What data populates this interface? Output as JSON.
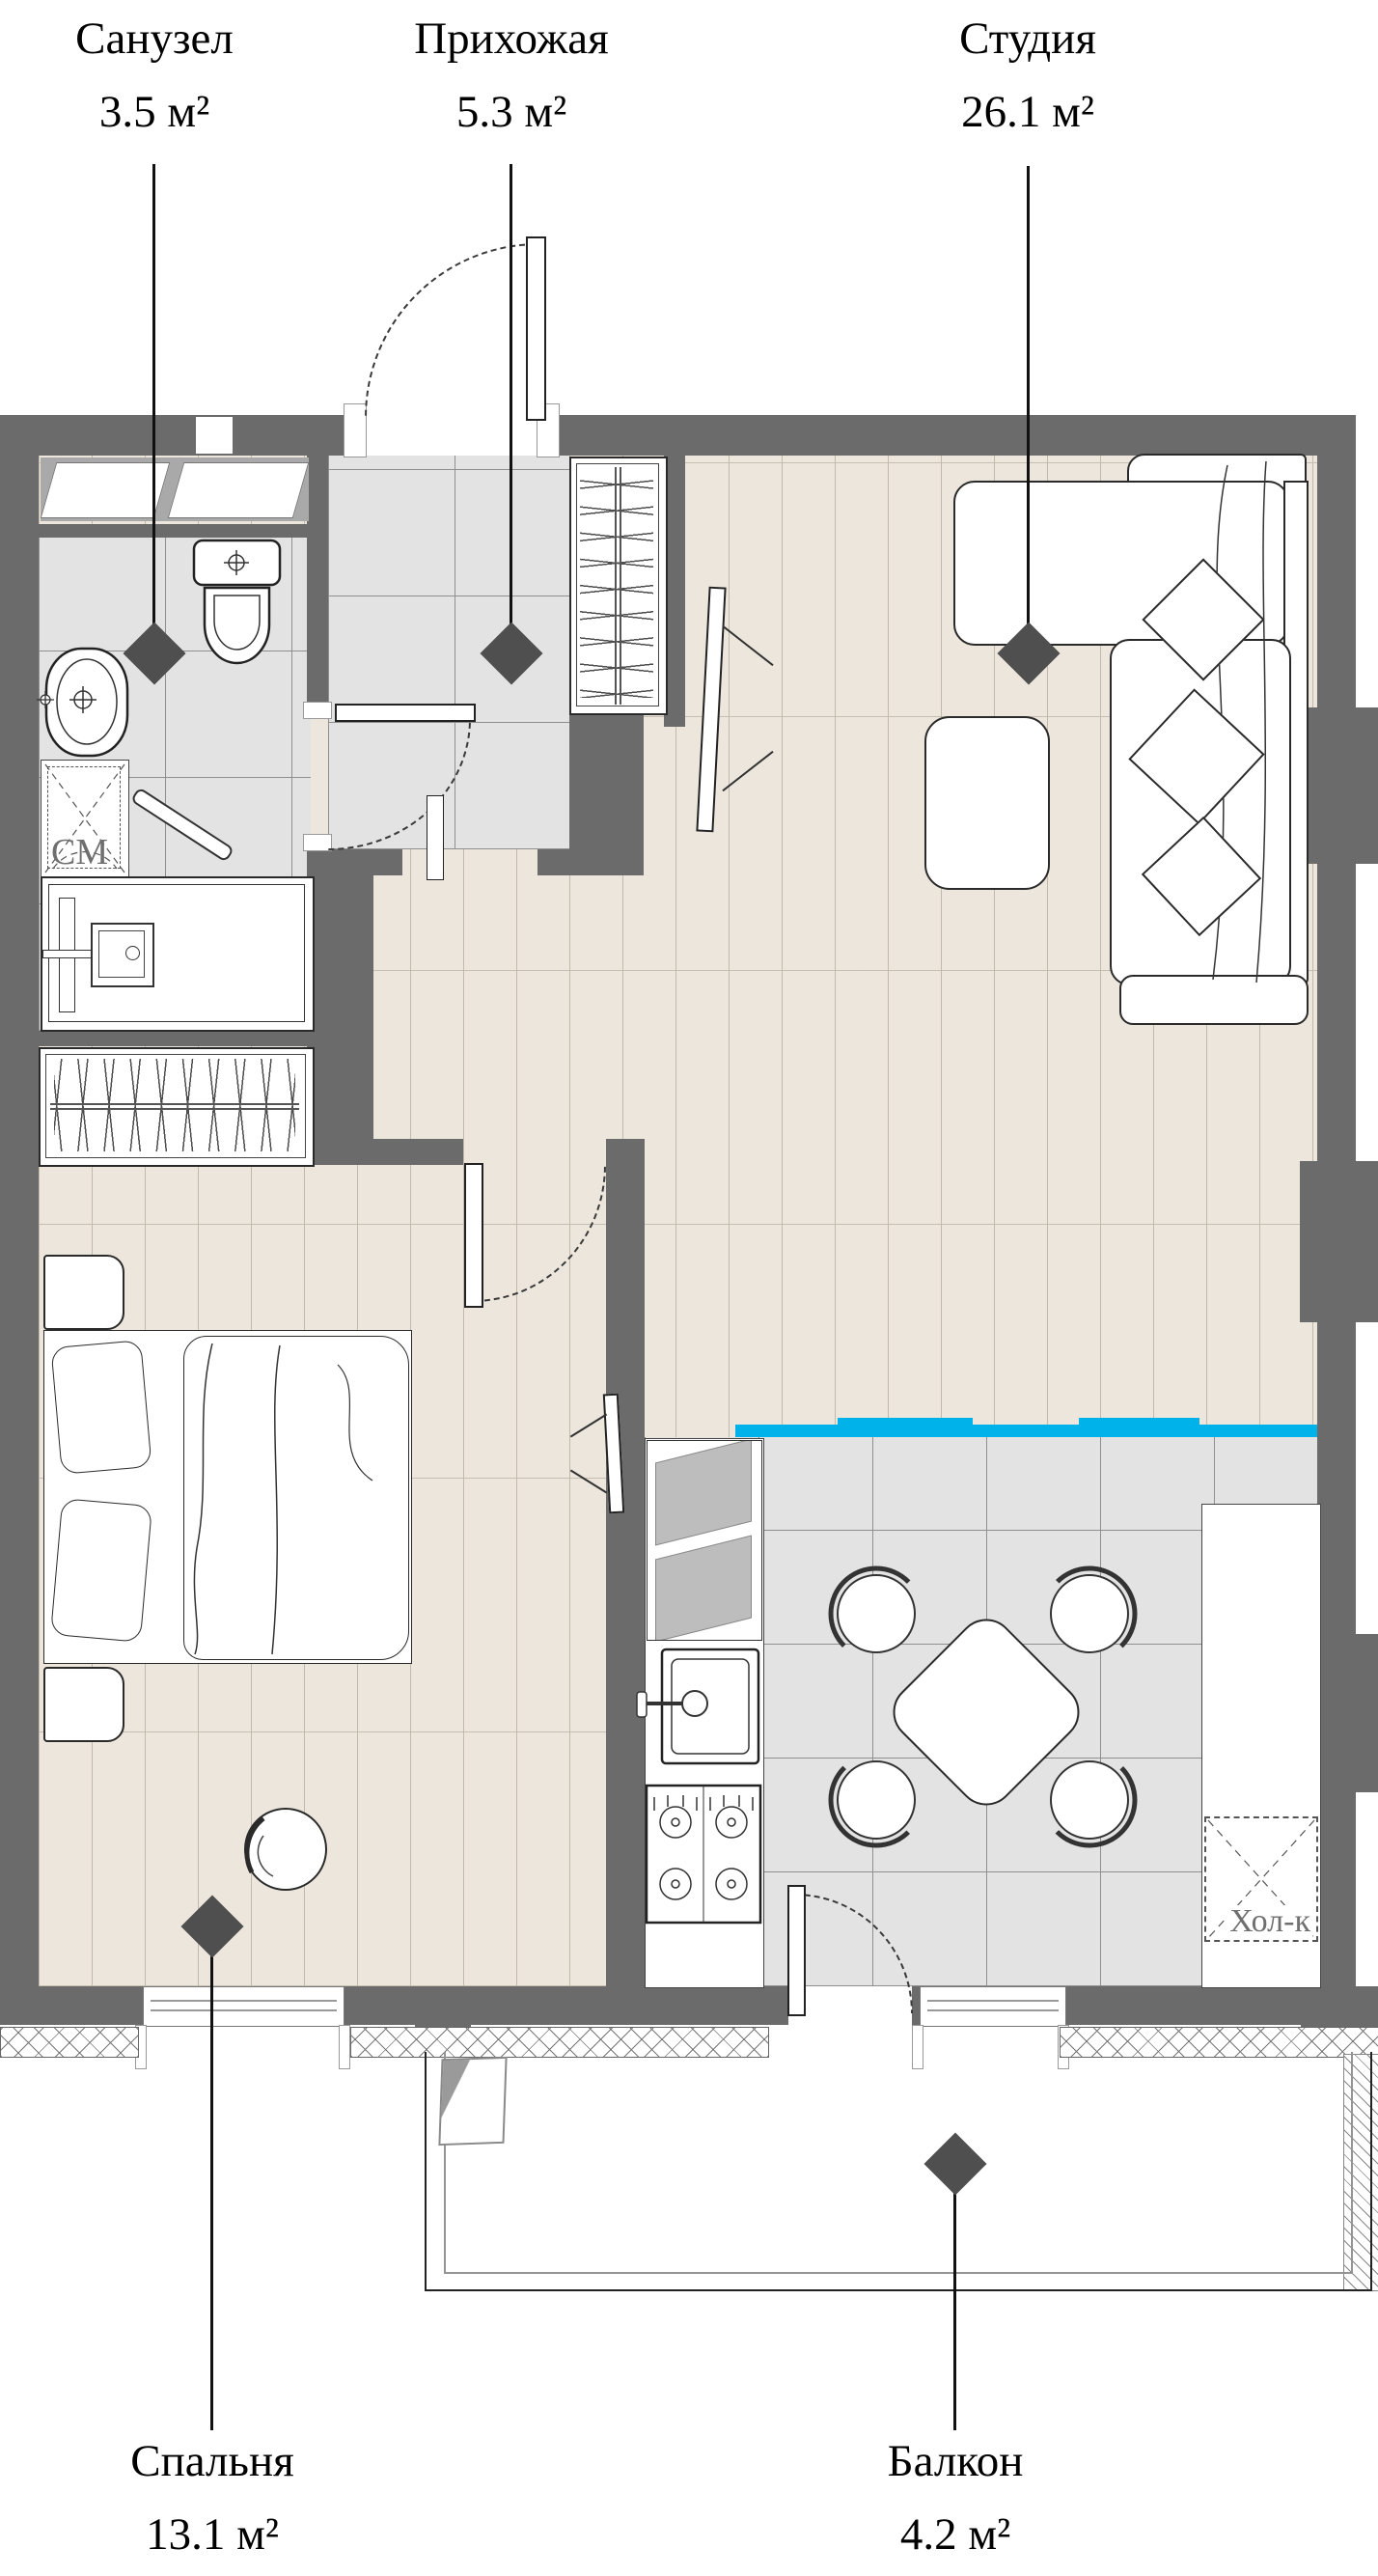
{
  "rooms": [
    {
      "id": "bathroom",
      "name": "Санузел",
      "area": "3.5 м²"
    },
    {
      "id": "hallway",
      "name": "Прихожая",
      "area": "5.3 м²"
    },
    {
      "id": "studio",
      "name": "Студия",
      "area": "26.1 м²"
    },
    {
      "id": "bedroom",
      "name": "Спальня",
      "area": "13.1 м²"
    },
    {
      "id": "balcony",
      "name": "Балкон",
      "area": "4.2 м²"
    }
  ],
  "fixtures": {
    "washing_machine": "СМ",
    "fridge": "Хол-к"
  },
  "colors": {
    "wall": "#6b6b6b",
    "wood": "#ece6dc",
    "wood_line": "#c2b9ab",
    "tile": "#e3e3e3",
    "tile_line": "#8f8f8f",
    "accent": "#00b2ea",
    "niche": "#a9a9a9",
    "diamond": "#4f4f4f",
    "label": "#000000",
    "fixture_label": "#6f6f6f"
  }
}
